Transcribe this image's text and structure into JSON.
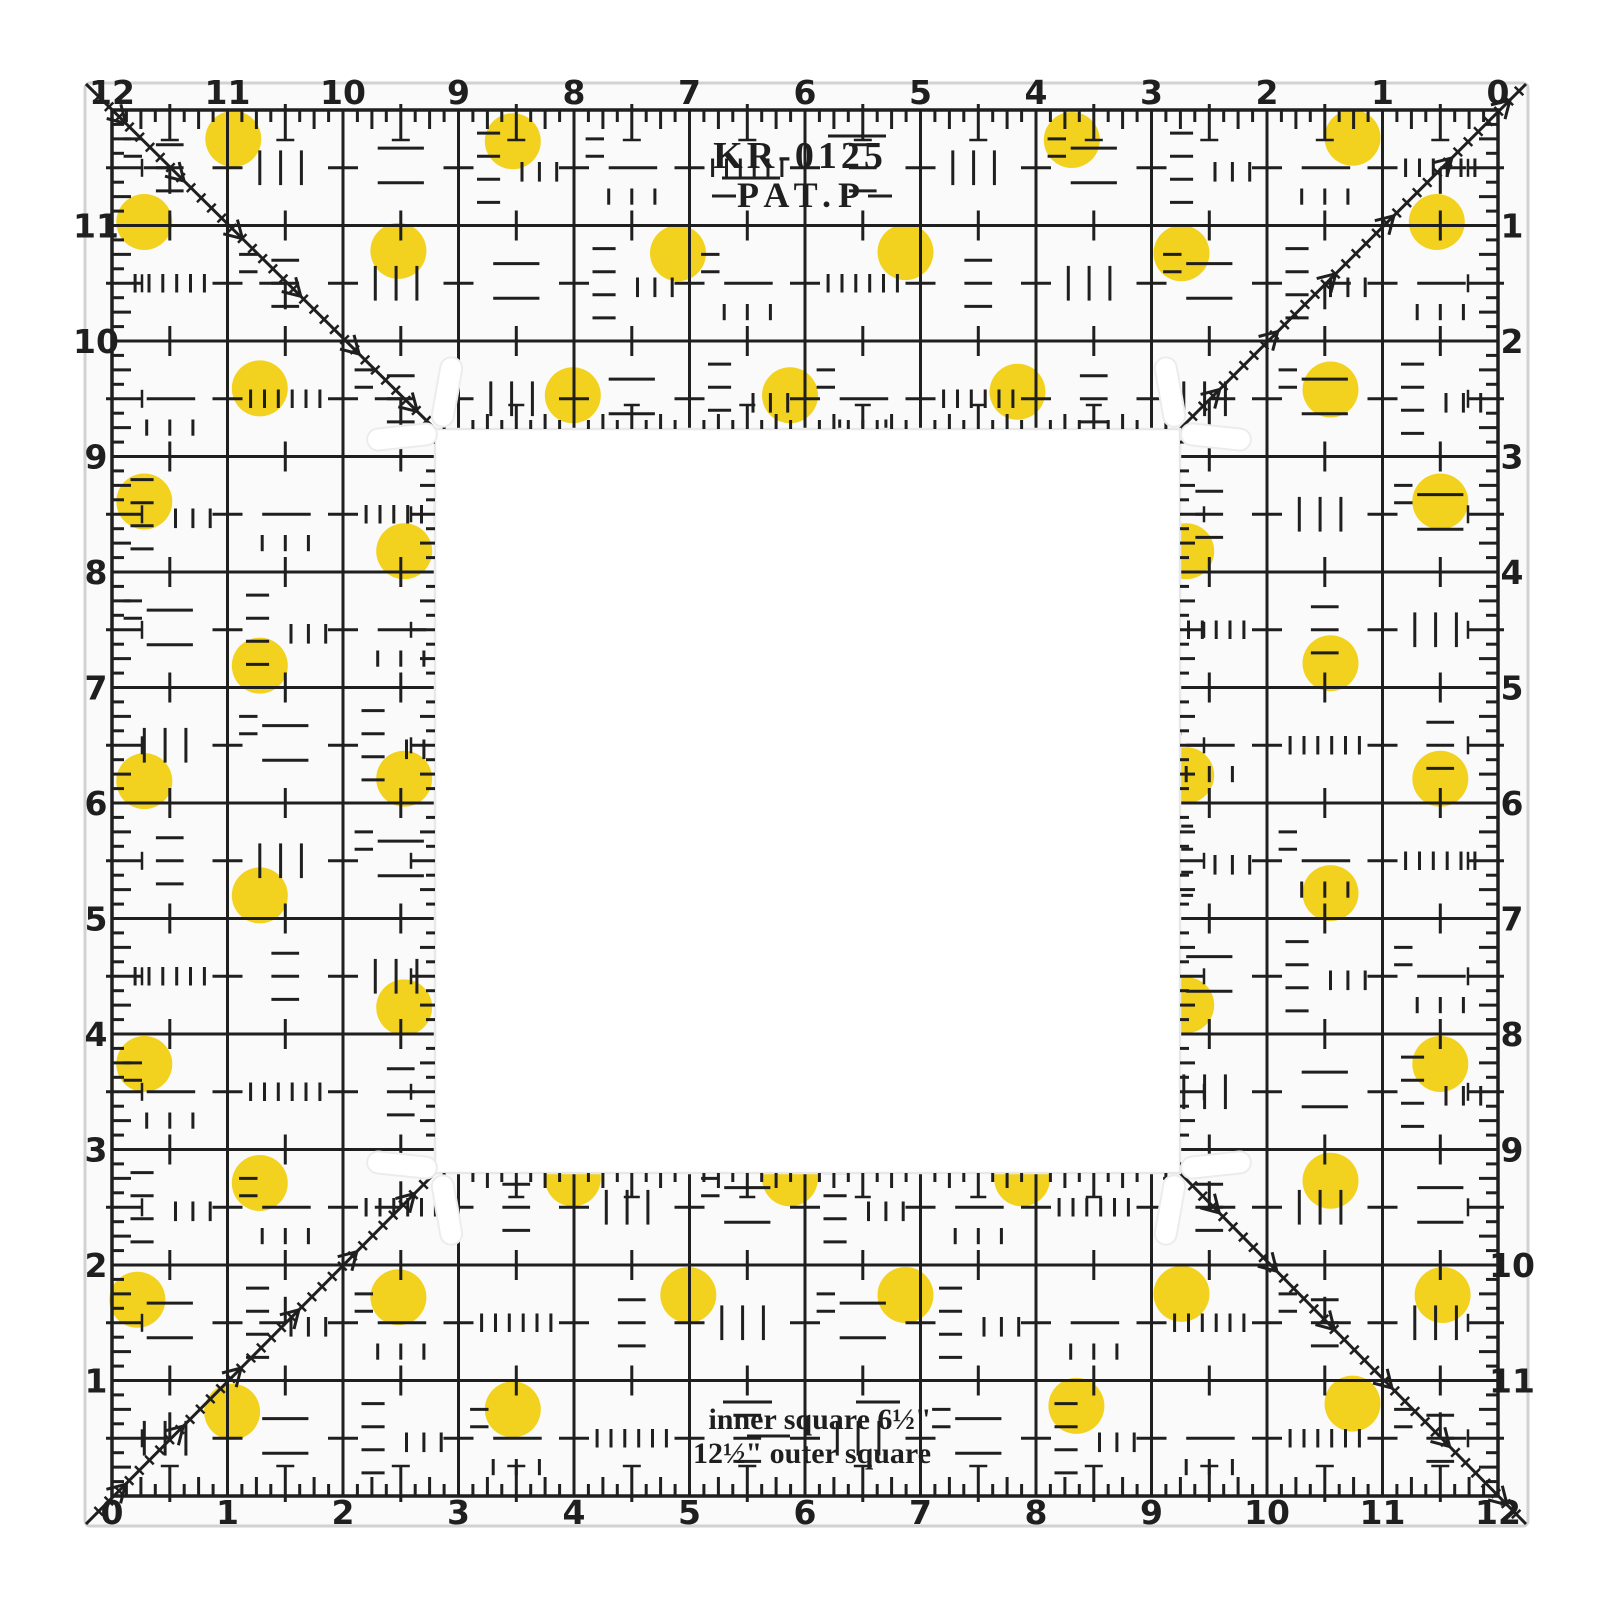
{
  "product": {
    "model": "KR-0125",
    "patent": "PAT.P",
    "inner_label": "inner square 6½\"",
    "outer_label": "12½\" outer square"
  },
  "scales": {
    "top": [
      "12",
      "11",
      "10",
      "9",
      "8",
      "7",
      "6",
      "5",
      "4",
      "3",
      "2",
      "1",
      "0"
    ],
    "bottom": [
      "0",
      "1",
      "2",
      "3",
      "4",
      "5",
      "6",
      "7",
      "8",
      "9",
      "10",
      "11",
      "12"
    ],
    "left": [
      "11",
      "10",
      "9",
      "8",
      "7",
      "6",
      "5",
      "4",
      "3",
      "2",
      "1"
    ],
    "right": [
      "1",
      "2",
      "3",
      "4",
      "5",
      "6",
      "7",
      "8",
      "9",
      "10",
      "11"
    ]
  },
  "colors": {
    "ink": "#1f1f1f",
    "dot_yellow": "#f2d21f",
    "acrylic": "#fafafa",
    "hole_white": "#ffffff",
    "edge_gray": "#d2d2d2",
    "slot_gray": "#ececec"
  },
  "dots_inches": [
    [
      1.05,
      0.25
    ],
    [
      3.47,
      0.27
    ],
    [
      8.31,
      0.26
    ],
    [
      10.74,
      0.24
    ],
    [
      0.28,
      0.97
    ],
    [
      11.47,
      0.97
    ],
    [
      2.48,
      1.22
    ],
    [
      4.9,
      1.24
    ],
    [
      6.87,
      1.23
    ],
    [
      9.26,
      1.24
    ],
    [
      1.28,
      2.41
    ],
    [
      3.99,
      2.47
    ],
    [
      5.87,
      2.47
    ],
    [
      7.84,
      2.44
    ],
    [
      10.55,
      2.42
    ],
    [
      0.28,
      3.39
    ],
    [
      2.53,
      3.82
    ],
    [
      9.3,
      3.82
    ],
    [
      11.5,
      3.39
    ],
    [
      1.28,
      4.81
    ],
    [
      10.55,
      4.79
    ],
    [
      0.28,
      5.81
    ],
    [
      2.53,
      5.79
    ],
    [
      9.3,
      5.76
    ],
    [
      11.5,
      5.79
    ],
    [
      1.28,
      6.8
    ],
    [
      10.55,
      6.78
    ],
    [
      2.53,
      7.77
    ],
    [
      9.3,
      7.75
    ],
    [
      0.28,
      8.26
    ],
    [
      11.5,
      8.26
    ],
    [
      1.28,
      9.29
    ],
    [
      3.99,
      9.25
    ],
    [
      5.87,
      9.25
    ],
    [
      7.88,
      9.25
    ],
    [
      10.55,
      9.27
    ],
    [
      0.22,
      10.3
    ],
    [
      2.48,
      10.28
    ],
    [
      4.99,
      10.26
    ],
    [
      6.87,
      10.26
    ],
    [
      9.26,
      10.25
    ],
    [
      11.52,
      10.26
    ],
    [
      1.04,
      11.27
    ],
    [
      3.47,
      11.25
    ],
    [
      8.35,
      11.22
    ],
    [
      10.74,
      11.2
    ]
  ]
}
